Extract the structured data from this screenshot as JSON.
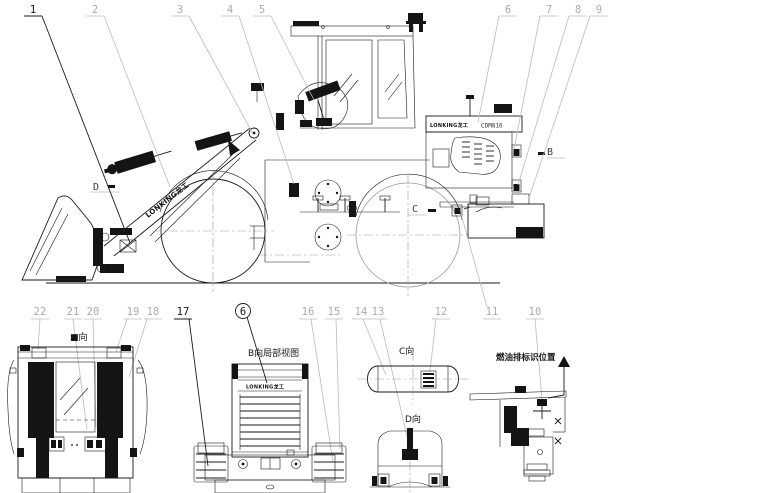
{
  "colors": {
    "background": "#ffffff",
    "ink": "#1a1a1a",
    "leader_line": "#bcbcbc",
    "dim_line": "#9a9a9a",
    "light_number": "#ababab"
  },
  "callouts": {
    "top": [
      "1",
      "2",
      "3",
      "4",
      "5",
      "6",
      "7",
      "8",
      "9"
    ],
    "bottom": [
      "22",
      "21",
      "20",
      "19",
      "18",
      "17",
      "16",
      "15",
      "14",
      "13",
      "12",
      "11",
      "10"
    ],
    "circled": "6"
  },
  "direction_markers": {
    "b": "B",
    "c": "C",
    "d": "D"
  },
  "view_labels": {
    "rear": "■向",
    "b_partial": "B向局部视图",
    "c": "C向",
    "d": "D向",
    "fuel": "燃油排标识位置"
  },
  "decals": {
    "boom_logo": "LONKING龙工",
    "hood_logo": "LONKING龙工",
    "hood_model": "CDM816",
    "grille_logo": "LONKING龙工"
  }
}
